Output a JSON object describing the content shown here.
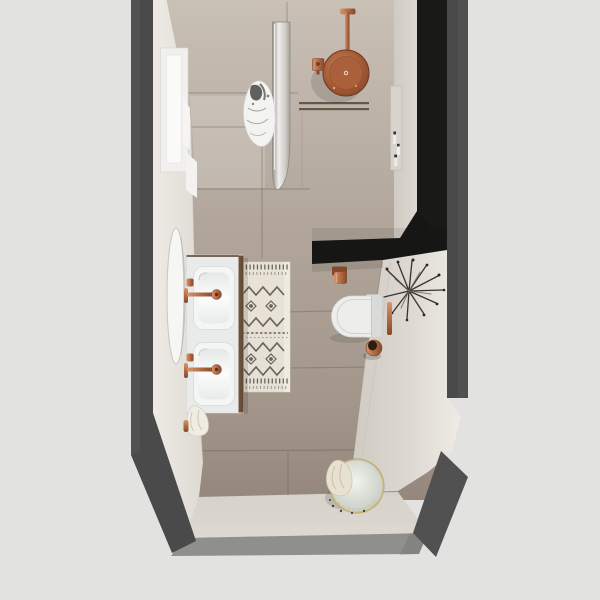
{
  "scene": {
    "description": "top-down 3d render of a narrow bathroom",
    "room": "bathroom",
    "view": "overhead plan render",
    "visible_text": "none"
  },
  "palette": {
    "background": "#e2e2e0",
    "outer_wall": "#4a4a4a",
    "outer_wall_light": "#585858",
    "black_wall": "#191917",
    "partition_black": "#161614",
    "floor_light": "#c9c0b6",
    "floor_mid": "#b2a69b",
    "floor_dark": "#95877c",
    "grout": "#60554a",
    "wall_face": "#dedad3",
    "wall_face_bright": "#eeebe5",
    "south_face": "#d6d2ca",
    "top_band": "#8f8f8d",
    "copper": "#b26b45",
    "copper_dark": "#84492c",
    "copper_light": "#d8966c",
    "fixture_white": "#edeeec",
    "vanity_white": "#e9eaea",
    "basin_white": "#f4f5f5",
    "wood_edge": "#5e4634",
    "mirror_white": "#f6f6f4",
    "glass_edge": "#8a867f",
    "rug_base": "#e9e4d9",
    "rug_ink": "#554e45",
    "plant_ink": "#2b2620",
    "basket_body": "#ccd3c9",
    "basket_rim": "#c9b478",
    "towel_cream": "#efece4",
    "towel_white": "#f3f3f1",
    "drain": "#57503f",
    "window_frame": "#f1f0ee",
    "window_glass": "#fafaf9",
    "niche": "#d8d4cd",
    "slab_gray": "#dadbd9",
    "band_dark": "#7b7b79",
    "shadow": "#000000"
  },
  "objects": [
    {
      "name": "window",
      "kind": "window",
      "location": "west wall, shower end"
    },
    {
      "name": "wall-mirror",
      "kind": "mirror",
      "location": "west wall above vanity"
    },
    {
      "name": "double-vanity",
      "kind": "vanity",
      "basins": 2,
      "finish": "white + wood edge"
    },
    {
      "name": "vanity-faucet-1",
      "kind": "wall faucet",
      "finish": "copper"
    },
    {
      "name": "vanity-faucet-2",
      "kind": "wall faucet",
      "finish": "copper"
    },
    {
      "name": "patterned-rug",
      "kind": "berber runner rug"
    },
    {
      "name": "glass-shower-screen",
      "kind": "glass partition"
    },
    {
      "name": "towel-on-screen",
      "kind": "towel",
      "pattern": "marble"
    },
    {
      "name": "rain-shower-head",
      "kind": "ceiling shower",
      "finish": "copper"
    },
    {
      "name": "shower-mixer",
      "kind": "mixer valve",
      "finish": "copper"
    },
    {
      "name": "linear-drain",
      "kind": "floor drain"
    },
    {
      "name": "shower-niche-bottles",
      "kind": "toiletries in wall niche"
    },
    {
      "name": "wall-hung-toilet",
      "kind": "toilet",
      "finish": "white"
    },
    {
      "name": "toilet-brush-holder",
      "kind": "accessory",
      "finish": "copper"
    },
    {
      "name": "copper-towel-hook",
      "kind": "hook on black partition"
    },
    {
      "name": "dried-plant",
      "kind": "wall decor"
    },
    {
      "name": "laundry-basket",
      "kind": "basket with towel"
    },
    {
      "name": "towel-under-vanity",
      "kind": "towel"
    }
  ]
}
